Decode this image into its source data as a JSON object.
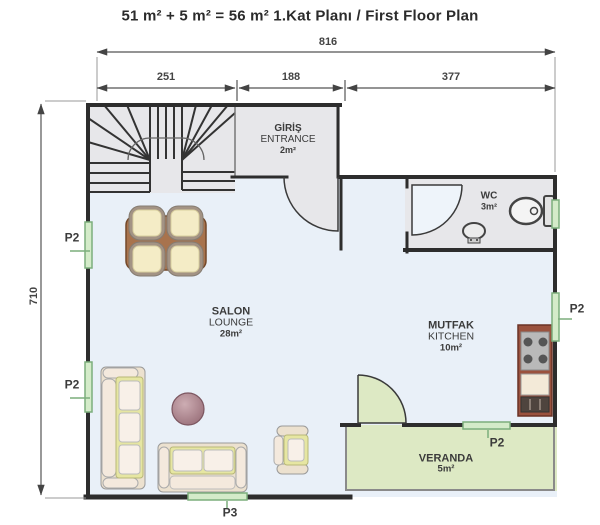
{
  "title": "51 m² + 5 m² = 56 m²  1.Kat Planı / First Floor Plan",
  "dimensions": {
    "total": "816",
    "seg1": "251",
    "seg2": "188",
    "seg3": "377",
    "height": "710"
  },
  "rooms": {
    "entrance": {
      "name": "GİRİŞ",
      "name_en": "ENTRANCE",
      "area": "2m²"
    },
    "wc": {
      "name": "WC",
      "area": "3m²"
    },
    "salon": {
      "name": "SALON",
      "name_en": "LOUNGE",
      "area": "28m²"
    },
    "kitchen": {
      "name": "MUTFAK",
      "name_en": "KITCHEN",
      "area": "10m²"
    },
    "veranda": {
      "name": "VERANDA",
      "area": "5m²"
    }
  },
  "openings": {
    "p2_label": "P2",
    "p3_label": "P3"
  },
  "colors": {
    "wall": "#2d2d2d",
    "floor": "#e9f0f8",
    "service": "#e7e7ea",
    "veranda": "#dde9c4",
    "window-fill": "#d4ebc9",
    "window-border": "#7cae7c",
    "text": "#3b3b3b",
    "dim": "#444444"
  }
}
